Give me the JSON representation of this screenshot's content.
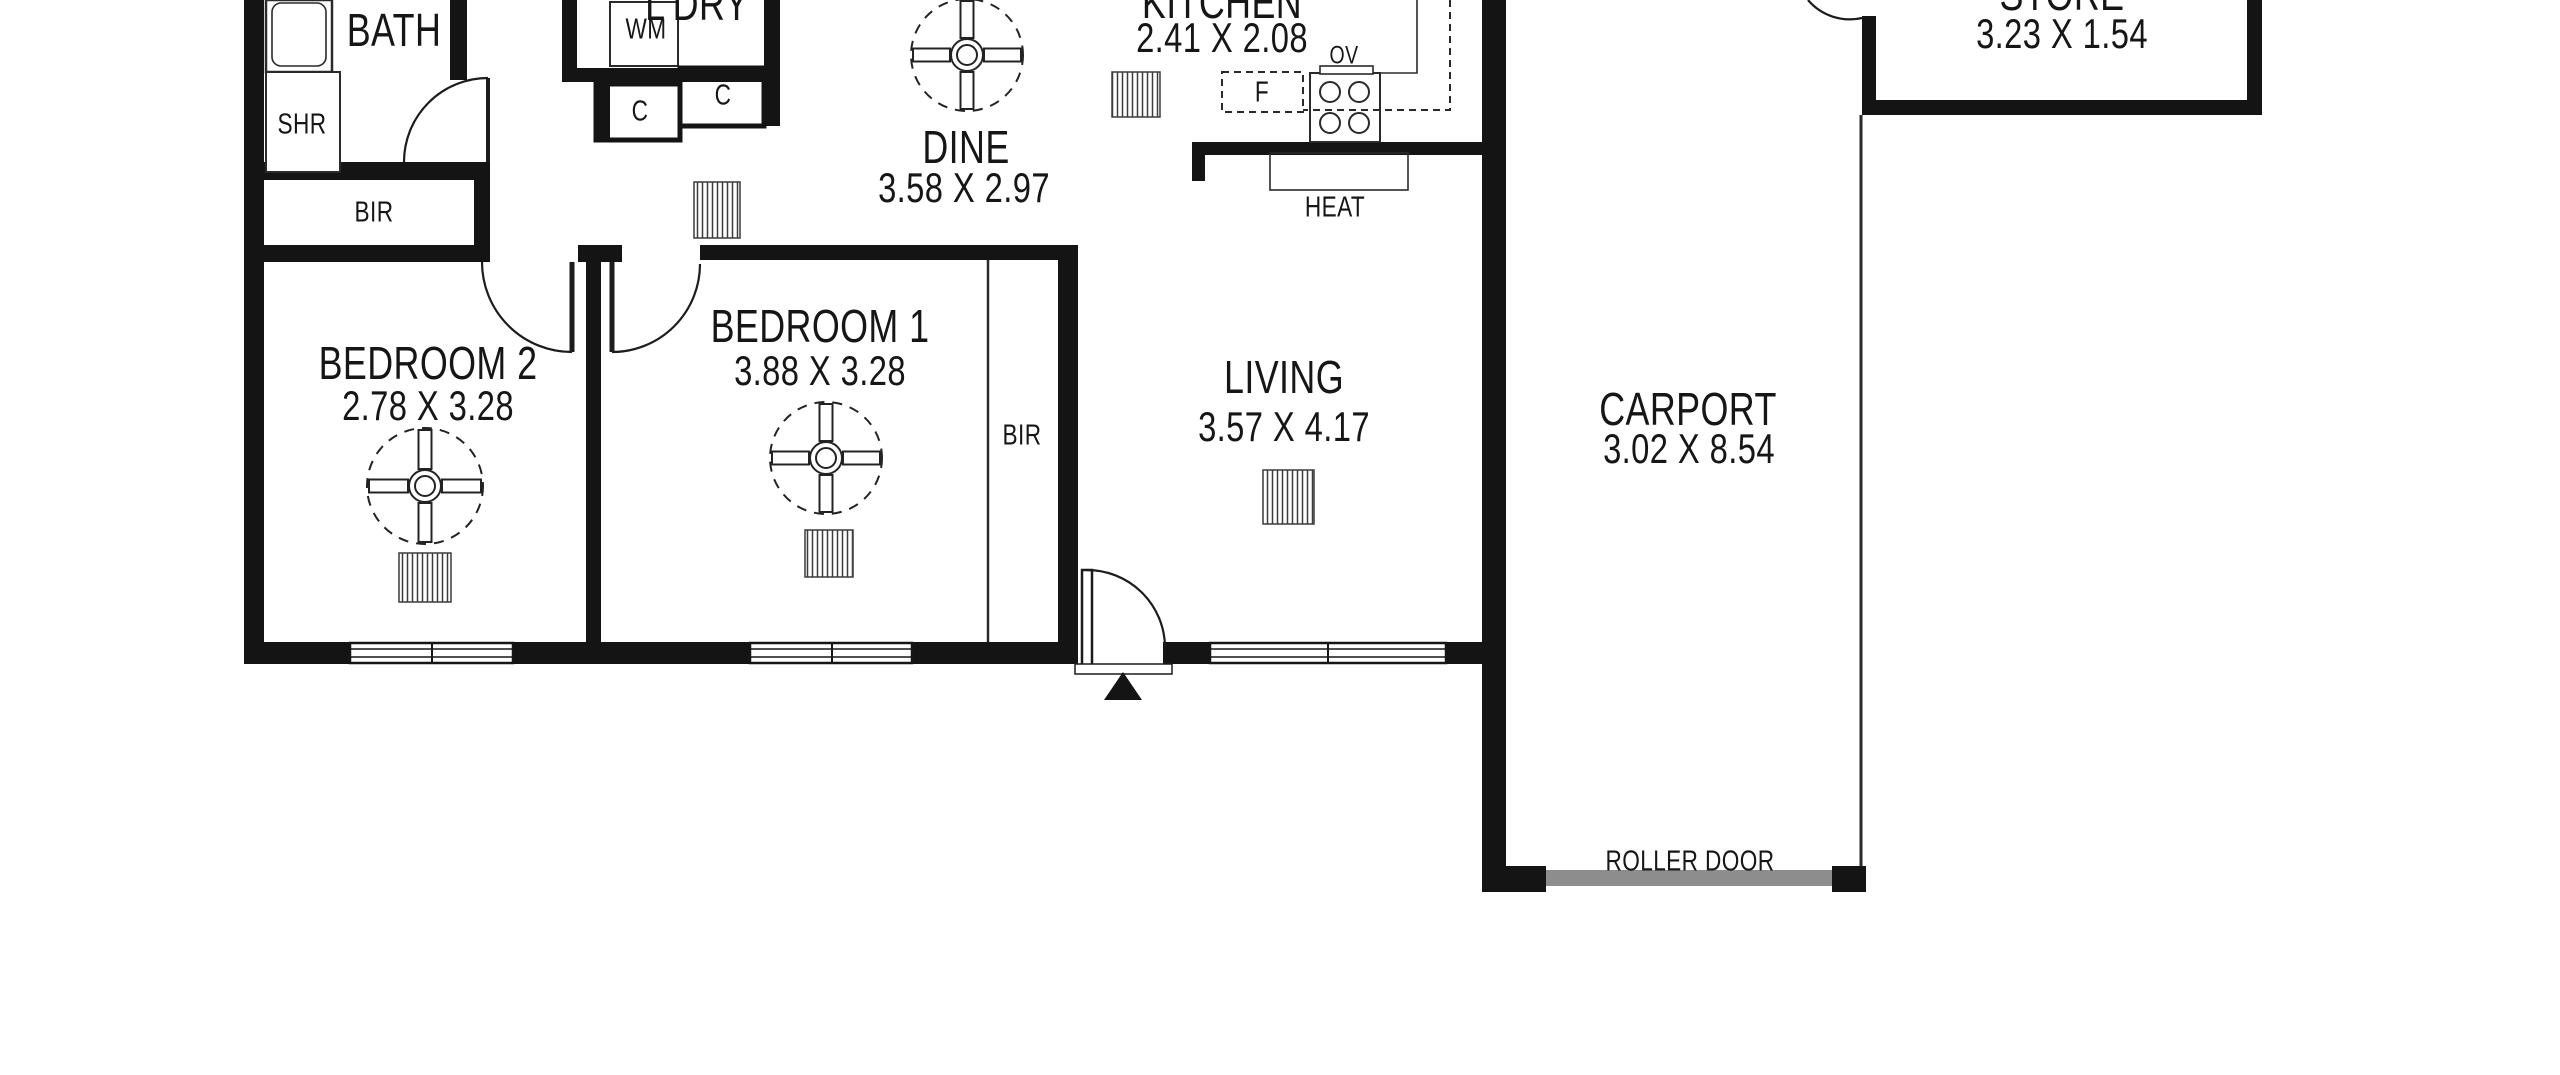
{
  "colors": {
    "background": "#ffffff",
    "walls": "#141414",
    "thin_line": "#2a2a2a",
    "roller_door": "#8d8d8d"
  },
  "rooms": {
    "bath": {
      "name": "BATH"
    },
    "laundry": {
      "name": "L'DRY"
    },
    "kitchen": {
      "name": "KITCHEN",
      "dims": "2.41 X 2.08"
    },
    "dine": {
      "name": "DINE",
      "dims": "3.58 X 2.97"
    },
    "bedroom2": {
      "name": "BEDROOM 2",
      "dims": "2.78 X 3.28"
    },
    "bedroom1": {
      "name": "BEDROOM 1",
      "dims": "3.88 X 3.28"
    },
    "living": {
      "name": "LIVING",
      "dims": "3.57 X 4.17"
    },
    "carport": {
      "name": "CARPORT",
      "dims": "3.02 X 8.54"
    },
    "store": {
      "name": "STORE",
      "dims": "3.23 X 1.54"
    }
  },
  "fixtures": {
    "shower": "SHR",
    "washing_machine": "WM",
    "cupboard_1": "C",
    "cupboard_2": "C",
    "hall_robe": "BIR",
    "bedroom1_robe": "BIR",
    "fridge": "F",
    "oven": "OV",
    "heater": "HEAT",
    "roller_door": "ROLLER DOOR"
  }
}
